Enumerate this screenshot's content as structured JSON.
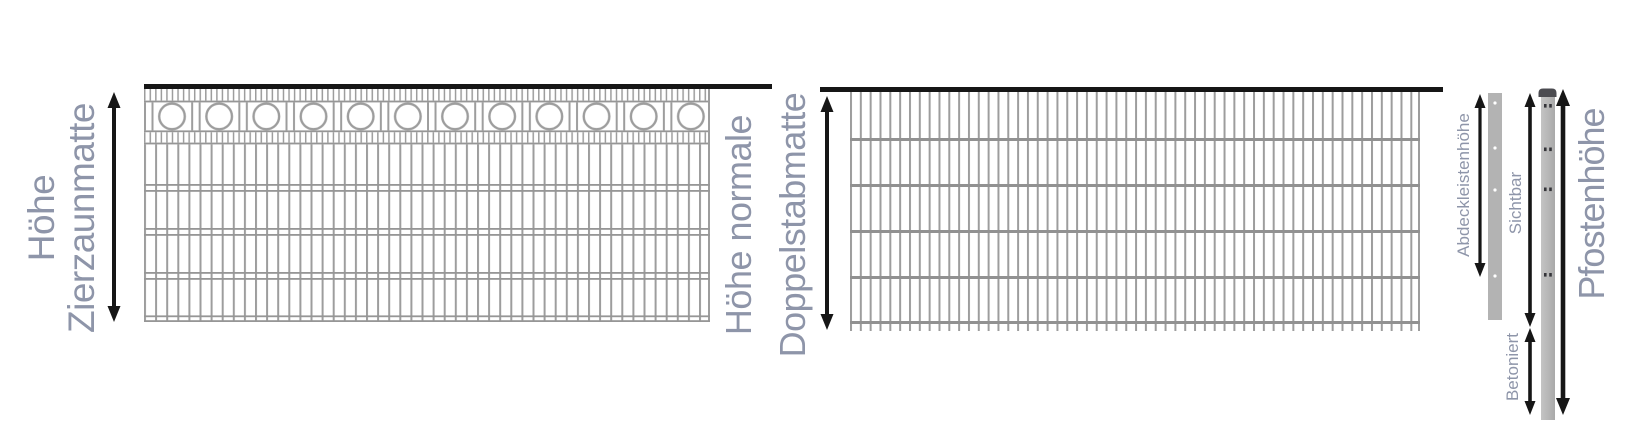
{
  "diagram": {
    "title_semantic": "Zaun-Massdiagramm",
    "left_panel": {
      "label_line1": "Höhe",
      "label_line2": "Zierzaunmatte"
    },
    "middle_panel": {
      "label_line1": "Höhe normale",
      "label_line2": "Doppelstabmatte"
    },
    "post_section": {
      "cover_strip_label": "Abdeckleistenhöhe",
      "visible_label": "Sichtbar",
      "concreted_label": "Betoniert",
      "post_height_label": "Pfostenhöhe"
    },
    "colors": {
      "label_text": "#8e95a9",
      "fence_gray": "#9d9d9d",
      "rail_gray": "#949494",
      "arrow_black": "#161616",
      "metal_gray": "#b3b3b3",
      "post_cap": "#4b4b50"
    }
  }
}
